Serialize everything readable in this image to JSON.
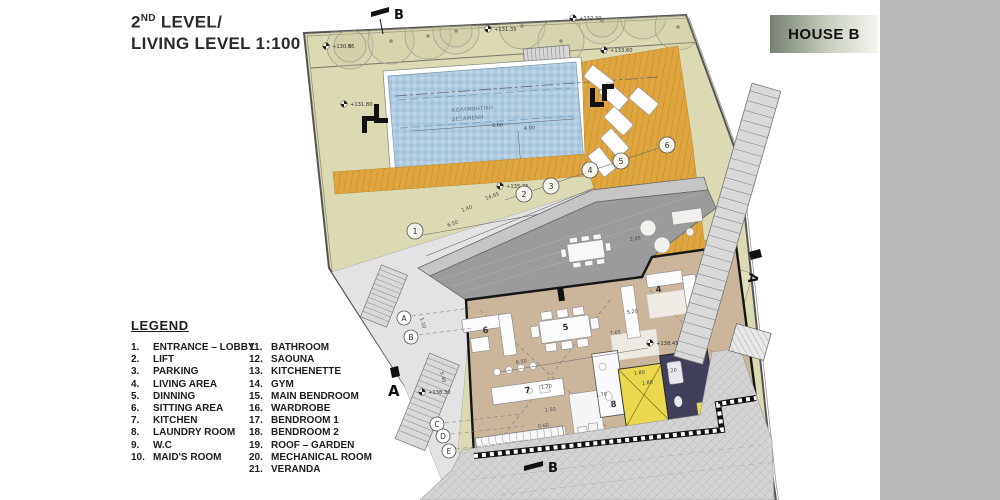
{
  "title": {
    "prefix": "2",
    "sup": "ND",
    "rest": " LEVEL/",
    "line2": "LIVING LEVEL 1:100"
  },
  "house_label": "HOUSE B",
  "legend": {
    "heading": "LEGEND",
    "col1": [
      [
        "1.",
        "ENTRANCE – LOBBY"
      ],
      [
        "2.",
        "LIFT"
      ],
      [
        "3.",
        "PARKING"
      ],
      [
        "4.",
        "LIVING AREA"
      ],
      [
        "5.",
        "DINNING"
      ],
      [
        "6.",
        "SITTING AREA"
      ],
      [
        "7.",
        "KITCHEN"
      ],
      [
        "8.",
        "LAUNDRY ROOM"
      ],
      [
        "9.",
        "W.C"
      ],
      [
        "10.",
        "MAID'S ROOM"
      ]
    ],
    "col2": [
      [
        "11.",
        "BATHROOM"
      ],
      [
        "12.",
        "SAOUNA"
      ],
      [
        "13.",
        "KITCHENETTE"
      ],
      [
        "14.",
        "GYM"
      ],
      [
        "15.",
        "MAIN BENDROOM"
      ],
      [
        "16.",
        "WARDROBE"
      ],
      [
        "17.",
        "BENDROOM 1"
      ],
      [
        "18.",
        "BENDROOM 2"
      ],
      [
        "19.",
        "ROOF – GARDEN"
      ],
      [
        "20.",
        "MECHANICAL ROOM"
      ],
      [
        "21.",
        "VERANDA"
      ]
    ]
  },
  "plan": {
    "pool_label": [
      "ΚΟΛΥΜΒΗΤΙΚΗ",
      "ΔΕΞΑΜΕΝΗ"
    ],
    "elevations": [
      "+130.55",
      "+131.35",
      "+132.30",
      "+133.60",
      "+131.80",
      "+135.35",
      "+138.45",
      "+138.30"
    ],
    "dims": [
      "9.60",
      "4.00",
      "1.00",
      "14.65",
      "1.40",
      "6.50",
      "1.80",
      "4.05",
      "2.70",
      "2.45",
      "7.65",
      "5.20",
      "6.50",
      "1.20",
      "1.50",
      "0.60",
      "1.70",
      "1.80",
      "1.80",
      "2.20",
      "1.75",
      "1.75",
      "1.10",
      "5.40"
    ],
    "circled_numbers": [
      "1",
      "2",
      "3",
      "4",
      "5",
      "6"
    ],
    "room_numbers": [
      "6",
      "5",
      "7",
      "8",
      "4"
    ],
    "grid_letters": [
      "A",
      "B",
      "C",
      "D",
      "E"
    ],
    "sections": {
      "top": "B",
      "bottom": "B",
      "left": "A",
      "right": "A"
    },
    "colors": {
      "site": "#dcdab2",
      "pool": "#aecbdf",
      "deck": "#dfa63f",
      "roof": "#9b9b9b",
      "floor": "#cbb69c",
      "lift": "#ead94f",
      "stair_core": "#40405a",
      "terrain": "#d4d4d4"
    }
  }
}
